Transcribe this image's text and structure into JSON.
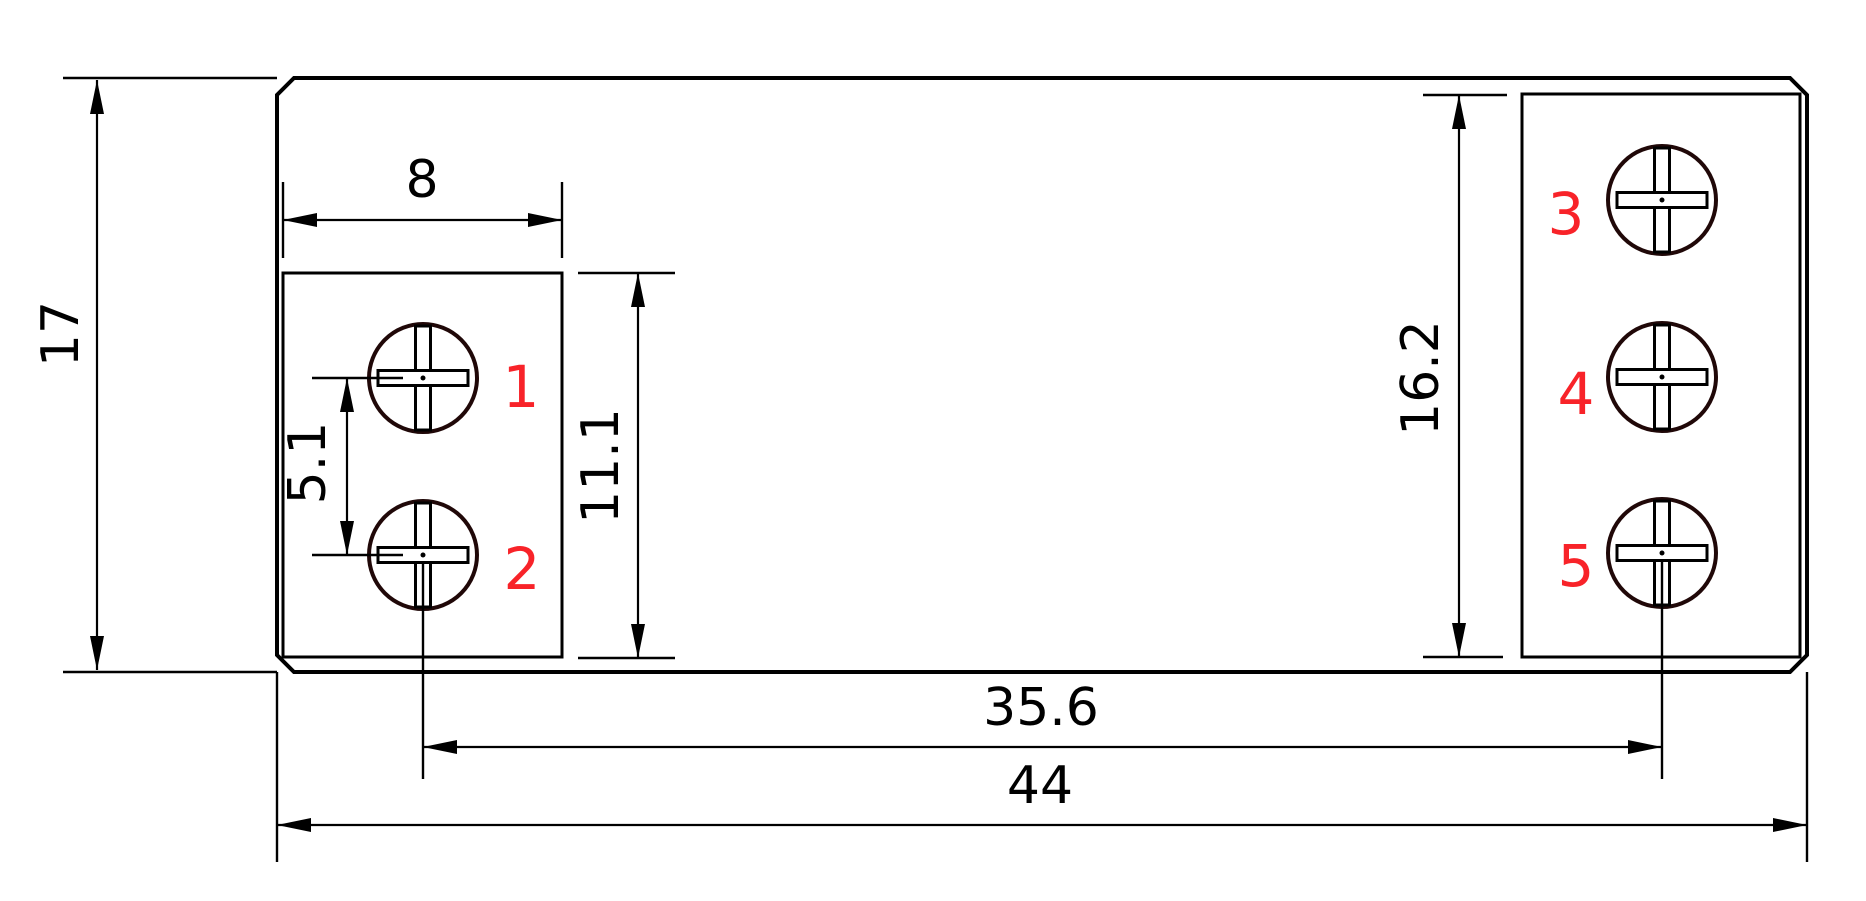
{
  "drawing": {
    "colors": {
      "background": "#ffffff",
      "line": "#000000",
      "screw_outline": "#200808",
      "terminal_label": "#f82329"
    },
    "terminals": [
      {
        "label": "1"
      },
      {
        "label": "2"
      },
      {
        "label": "3"
      },
      {
        "label": "4"
      },
      {
        "label": "5"
      }
    ],
    "dimensions": [
      {
        "name": "terminal-block-width",
        "value": "8",
        "orientation": "horizontal"
      },
      {
        "name": "screw-pitch",
        "value": "5.1",
        "orientation": "vertical"
      },
      {
        "name": "left-block-height",
        "value": "11.1",
        "orientation": "vertical"
      },
      {
        "name": "overall-height",
        "value": "17",
        "orientation": "vertical"
      },
      {
        "name": "right-block-height",
        "value": "16.2",
        "orientation": "vertical"
      },
      {
        "name": "screw-center-span",
        "value": "35.6",
        "orientation": "horizontal"
      },
      {
        "name": "overall-width",
        "value": "44",
        "orientation": "horizontal"
      }
    ]
  }
}
